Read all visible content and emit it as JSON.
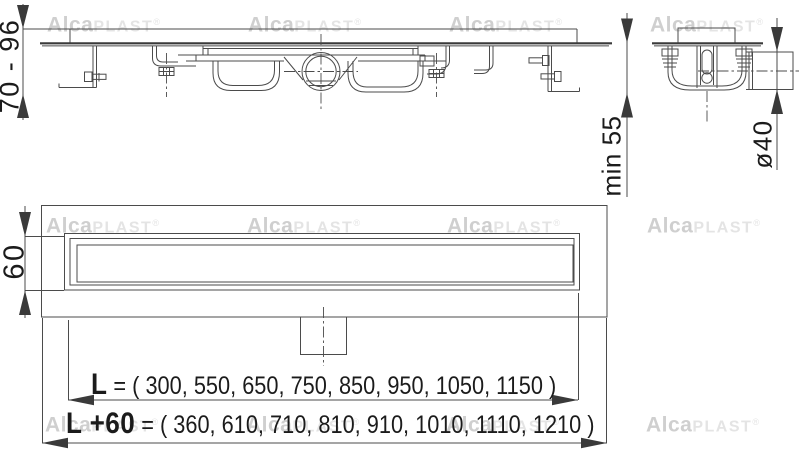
{
  "drawing": {
    "title_semantic": "linear shower drain technical drawing",
    "dimension_labels": {
      "installation_height_range": "70 - 96",
      "min_floor_depth": "min 55",
      "outlet_pipe_diameter": "ø40",
      "channel_width": "60"
    },
    "length_row": {
      "label": "L",
      "values": "= ( 300, 550, 650, 750, 850, 950, 1050, 1150 )"
    },
    "total_length_row": {
      "label": "L +60",
      "values": "= ( 360, 610, 710, 810, 910, 1010, 1110, 1210 )"
    },
    "watermark": {
      "bold": "Alca",
      "light": "PLAST",
      "registered": "®"
    },
    "colors": {
      "line": "#4b4b4b",
      "thick_line": "#3a3a3a",
      "text": "#1b1b1b",
      "watermark_bold": "#cfcfcf",
      "watermark_light": "#e4e4e4"
    }
  }
}
